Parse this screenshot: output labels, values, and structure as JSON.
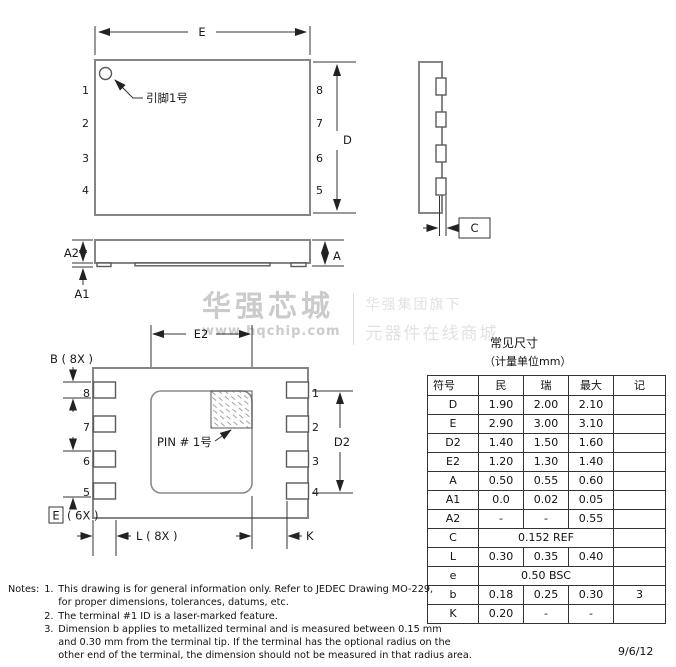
{
  "watermark": {
    "brand": "华强芯城",
    "url": "www.hqchip.com",
    "tagline_top": "华强集团旗下",
    "tagline_bottom": "元器件在线商城"
  },
  "top_view": {
    "dim_e": "E",
    "dim_d": "D",
    "pins_left": [
      "1",
      "2",
      "3",
      "4"
    ],
    "pins_right": [
      "8",
      "7",
      "6",
      "5"
    ],
    "pin1_label": "引脚1号"
  },
  "side_view": {
    "dim_a2": "A2",
    "dim_a1": "A1",
    "dim_a": "A"
  },
  "end_view": {
    "dim_c": "C"
  },
  "bottom_view": {
    "dim_e2": "E2",
    "dim_b": "B ( 8X )",
    "dim_d2": "D2",
    "pins_left": [
      "8",
      "7",
      "6",
      "5"
    ],
    "pins_right": [
      "1",
      "2",
      "3",
      "4"
    ],
    "pin1_label": "PIN # 1号",
    "dim_e_boxed": "E",
    "dim_e_count": "( 6X )",
    "dim_l": "L ( 8X )",
    "dim_k": "K"
  },
  "table": {
    "title": "常见尺寸",
    "unit": "（计量单位mm）",
    "headers": [
      "符号",
      "民",
      "瑞",
      "最大",
      "记"
    ],
    "rows": [
      {
        "cells": [
          "D",
          "1.90",
          "2.00",
          "2.10",
          ""
        ]
      },
      {
        "cells": [
          "E",
          "2.90",
          "3.00",
          "3.10",
          ""
        ]
      },
      {
        "cells": [
          "D2",
          "1.40",
          "1.50",
          "1.60",
          ""
        ]
      },
      {
        "cells": [
          "E2",
          "1.20",
          "1.30",
          "1.40",
          ""
        ]
      },
      {
        "cells": [
          "A",
          "0.50",
          "0.55",
          "0.60",
          ""
        ]
      },
      {
        "cells": [
          "A1",
          "0.0",
          "0.02",
          "0.05",
          ""
        ]
      },
      {
        "cells": [
          "A2",
          "-",
          "-",
          "0.55",
          ""
        ]
      },
      {
        "cells": [
          "C",
          "0.152 REF",
          ""
        ],
        "span": true
      },
      {
        "cells": [
          "L",
          "0.30",
          "0.35",
          "0.40",
          ""
        ]
      },
      {
        "cells": [
          "e",
          "0.50 BSC",
          ""
        ],
        "span": true
      },
      {
        "cells": [
          "b",
          "0.18",
          "0.25",
          "0.30",
          "3"
        ]
      },
      {
        "cells": [
          "K",
          "0.20",
          "-",
          "-",
          ""
        ]
      }
    ]
  },
  "notes": {
    "label": "Notes:",
    "items": [
      {
        "num": "1.",
        "text": "This drawing is for general information only. Refer to JEDEC Drawing MO-229,\nfor proper dimensions, tolerances, datums, etc."
      },
      {
        "num": "2.",
        "text": "The terminal #1 ID is a laser-marked feature."
      },
      {
        "num": "3.",
        "text": "Dimension b applies to metallized terminal and is measured between 0.15 mm\nand 0.30 mm from the terminal tip. If the terminal has the optional radius on the\nother end of the terminal, the dimension should not be measured in that radius area."
      }
    ]
  },
  "footer": {
    "date": "9/6/12"
  },
  "colors": {
    "line": "#333333",
    "body_outline": "#858585",
    "watermark": "#cbcbcb"
  }
}
